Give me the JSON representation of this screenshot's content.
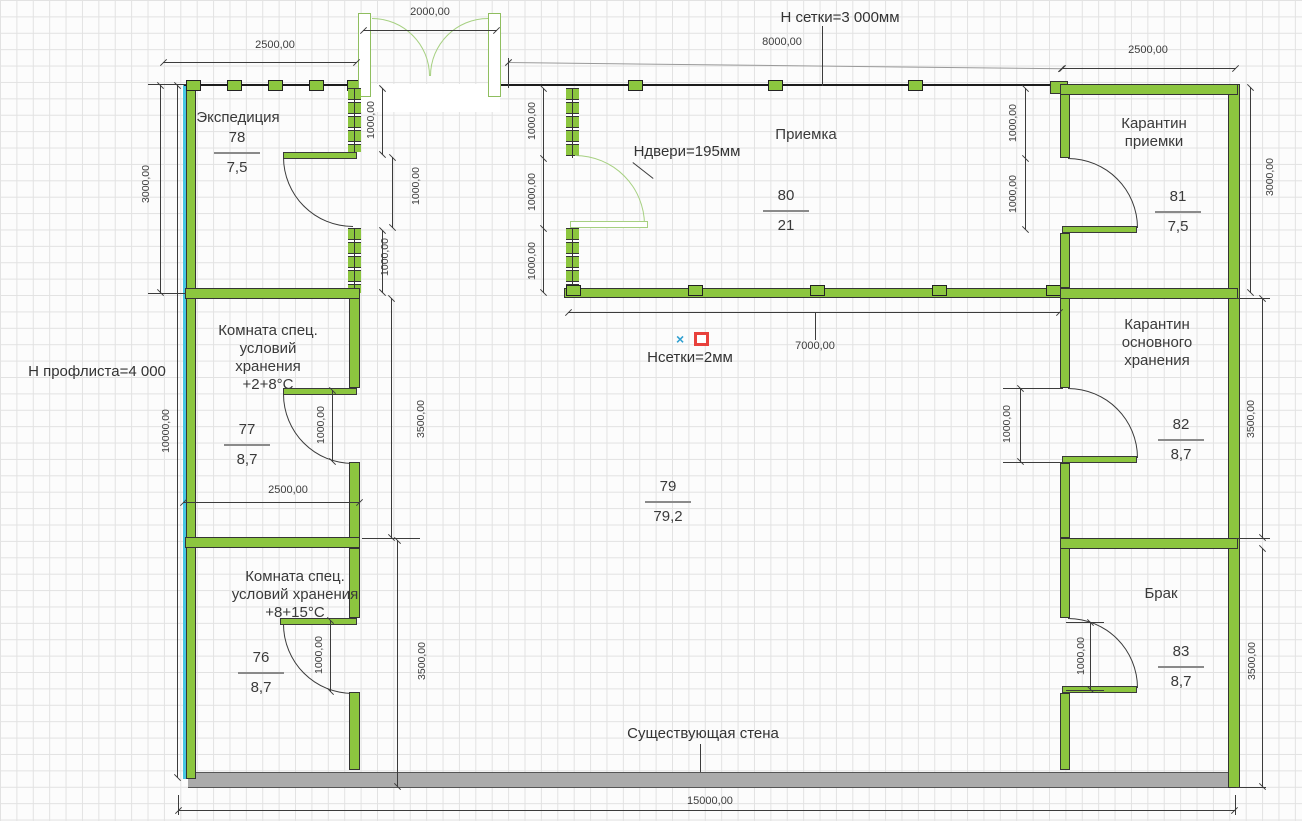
{
  "annotations": {
    "grid_height": "Н сетки=3 000мм",
    "prof_sheet_height": "Н профлиста=4 000",
    "door_height": "Ндвери=195мм",
    "mesh_height": "Нсетки=2мм",
    "existing_wall": "Существующая стена"
  },
  "dims": {
    "d2500": "2500,00",
    "d2000": "2000,00",
    "d8000": "8000,00",
    "d3000": "3000,00",
    "d10000": "10000,00",
    "d3500": "3500,00",
    "d1000": "1000,00",
    "d7000": "7000,00",
    "d15000": "15000,00"
  },
  "rooms": [
    {
      "name_lines": [
        "Экспедиция"
      ],
      "number": "78",
      "area": "7,5"
    },
    {
      "name_lines": [
        "Комната спец.",
        "условий",
        "хранения",
        "+2+8°C"
      ],
      "number": "77",
      "area": "8,7"
    },
    {
      "name_lines": [
        "Комната спец.",
        "условий хранения",
        "+8+15°C"
      ],
      "number": "76",
      "area": "8,7"
    },
    {
      "name_lines": [
        "Приемка"
      ],
      "number": "80",
      "area": "21"
    },
    {
      "name_lines": [
        "Карантин",
        "приемки"
      ],
      "number": "81",
      "area": "7,5"
    },
    {
      "name_lines": [
        "Карантин",
        "основного",
        "хранения"
      ],
      "number": "82",
      "area": "8,7"
    },
    {
      "name_lines": [
        "Брак"
      ],
      "number": "83",
      "area": "8,7"
    },
    {
      "name_lines": [],
      "number": "79",
      "area": "79,2"
    }
  ],
  "colors": {
    "wall_green": "#8cc63f",
    "door_green": "#a6d081",
    "membrane_cyan": "#45c6e2",
    "existing_wall_gray": "#ababab",
    "selection_red": "#e8413c",
    "snap_blue": "#2f9fd0"
  },
  "markers": {
    "snap_cross": "×"
  }
}
